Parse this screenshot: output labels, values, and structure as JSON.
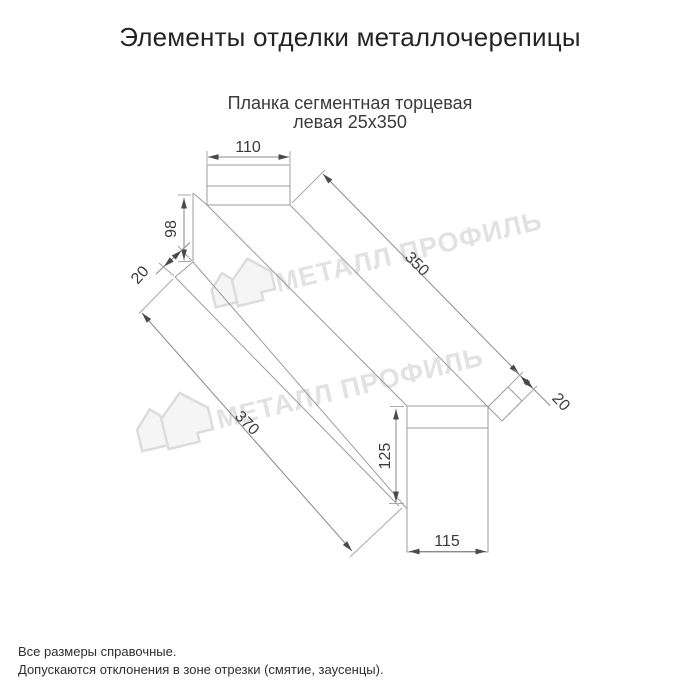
{
  "header": {
    "title": "Элементы отделки металлочерепицы"
  },
  "product": {
    "name_line1": "Планка сегментная торцевая",
    "name_line2": "левая 25х350"
  },
  "watermark": {
    "brand": "МЕТАЛЛ ПРОФИЛЬ"
  },
  "drawing": {
    "dim_top_width": "110",
    "dim_left_height": "98",
    "dim_left_hem": "20",
    "dim_length_top": "350",
    "dim_length_bottom": "370",
    "dim_right_flap": "20",
    "dim_right_height": "125",
    "dim_right_width": "115"
  },
  "footer": {
    "note1": "Все размеры справочные.",
    "note2": "Допускаются отклонения в зоне отрезки (смятие, заусенцы)."
  }
}
